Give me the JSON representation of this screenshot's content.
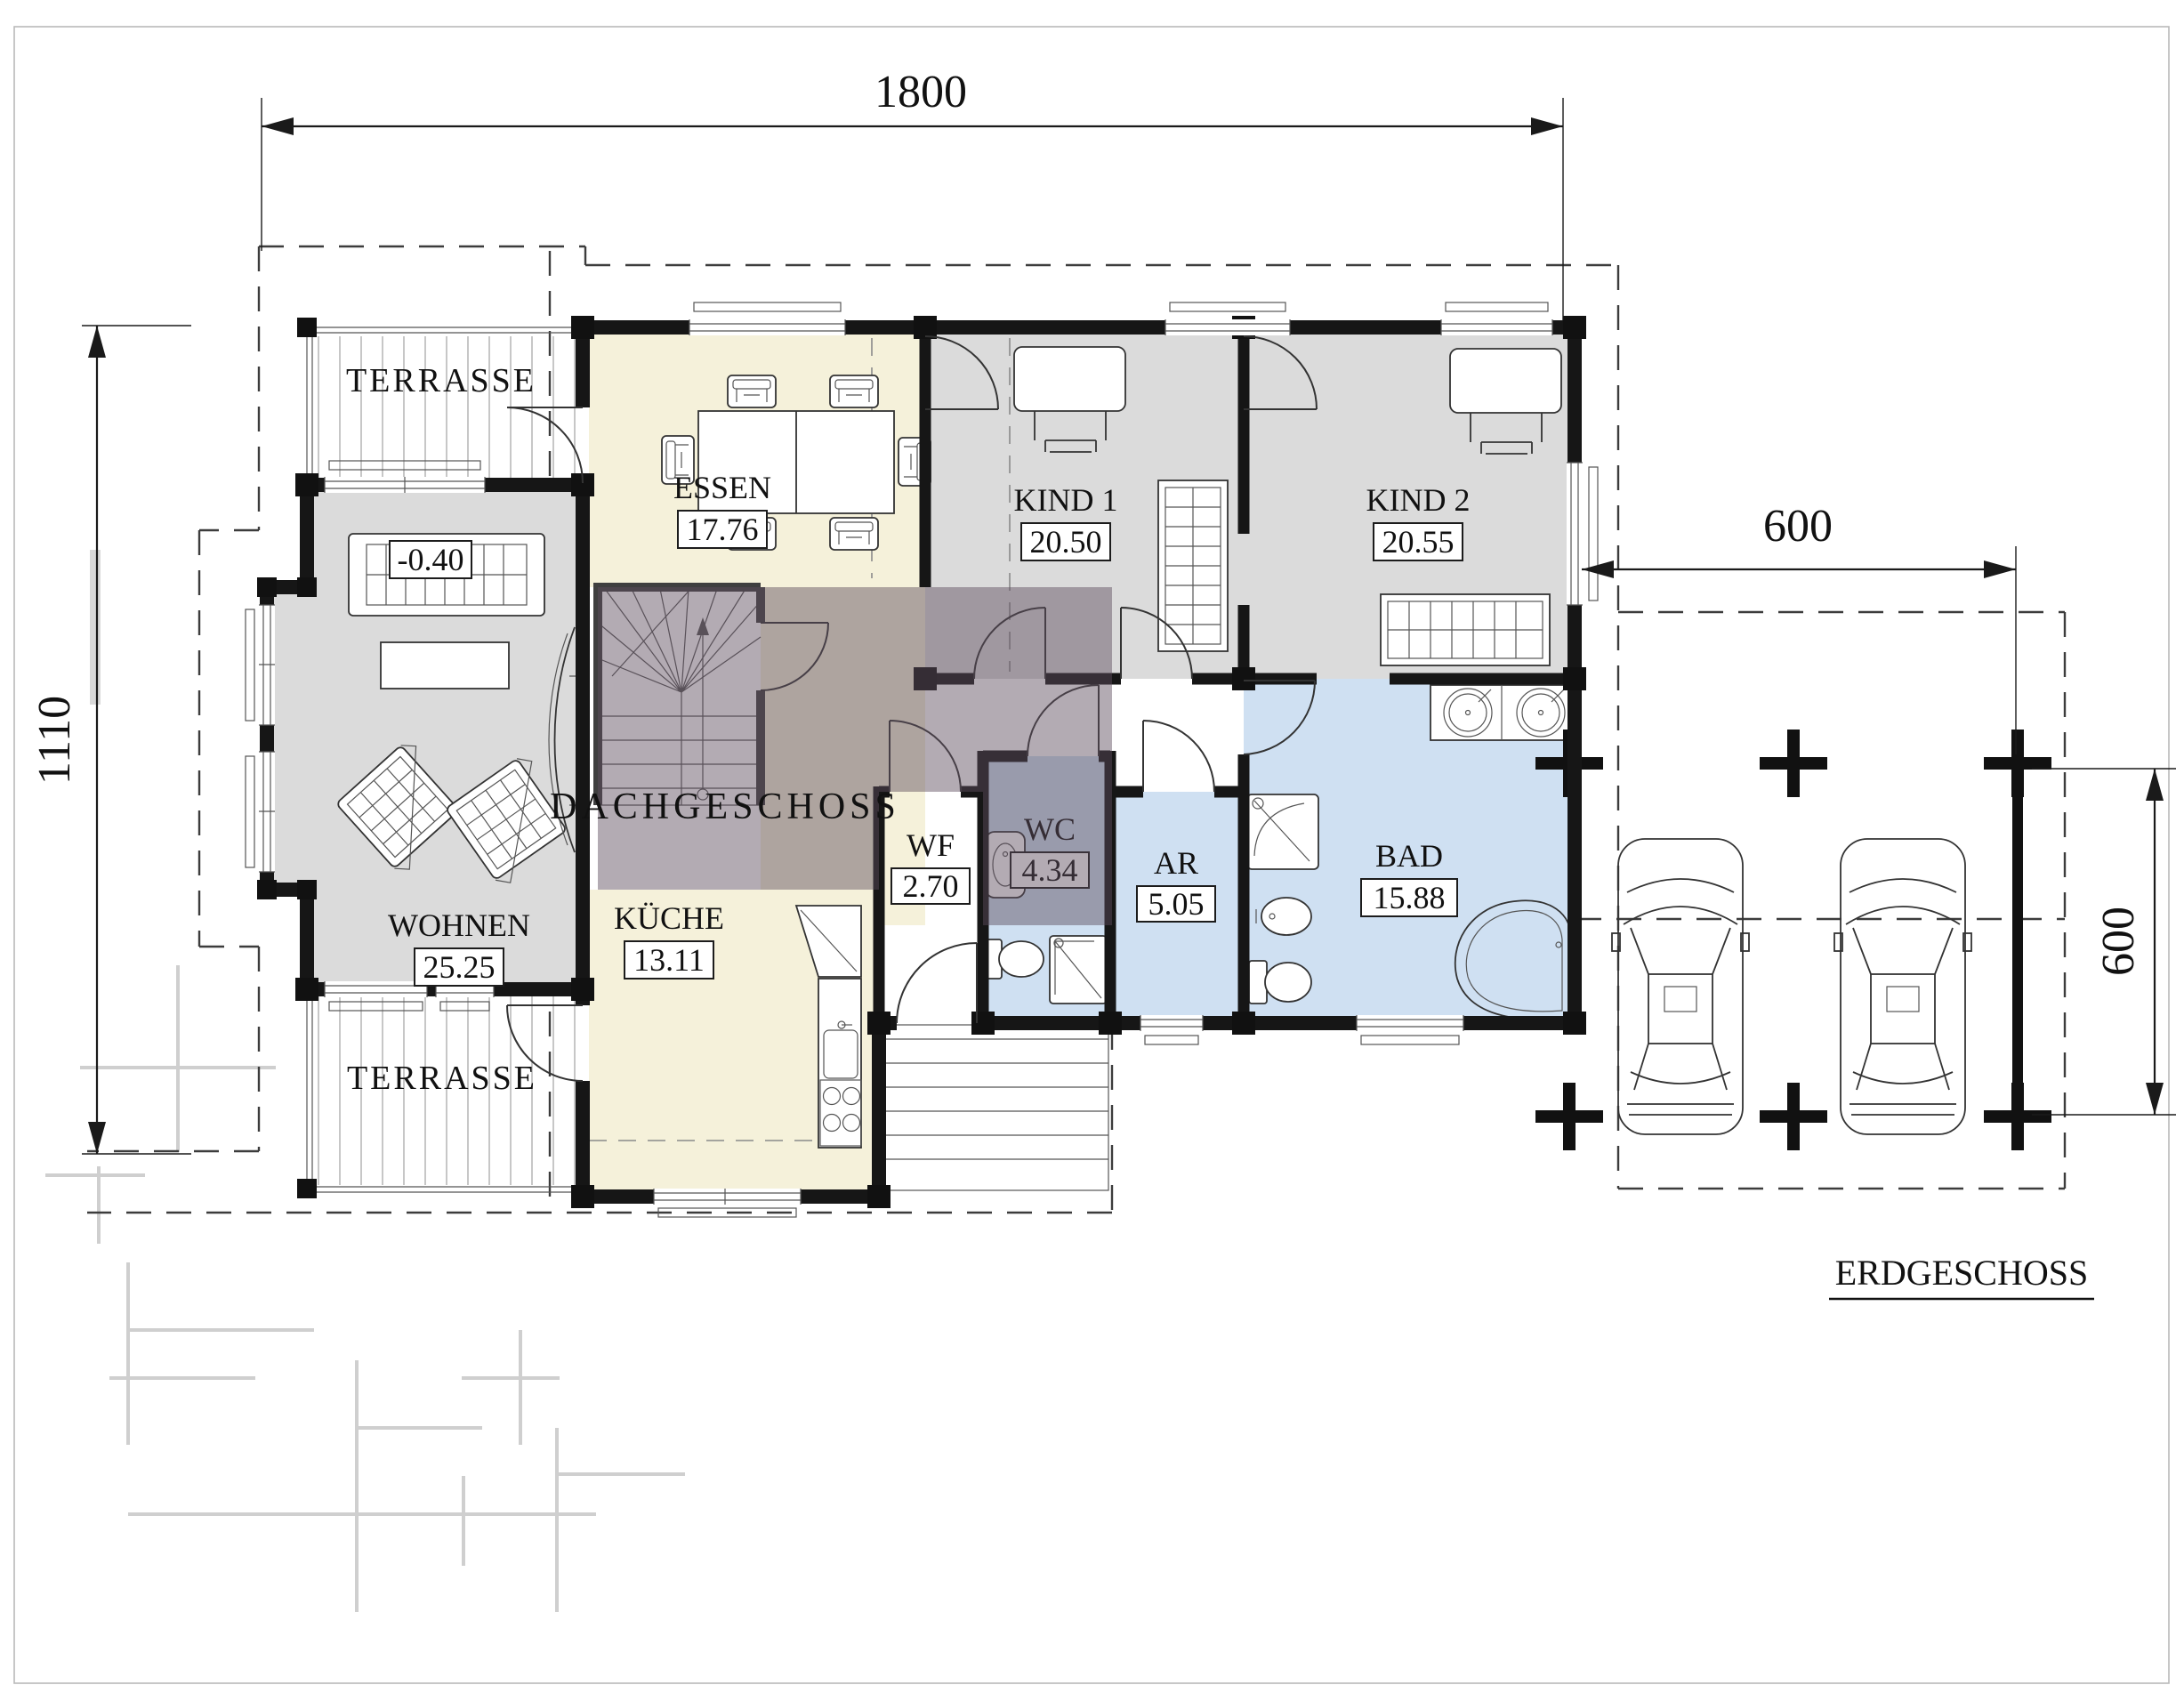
{
  "title": "Erdgeschoss Grundriss",
  "dimensions": {
    "top_width": "1800",
    "left_depth": "1110",
    "carport_width": "600",
    "carport_depth": "600"
  },
  "labels": {
    "terrace_top": "TERRASSE",
    "terrace_bottom": "TERRASSE",
    "overlay": "DACHGESCHOSS",
    "floor": "ERDGESCHOSS",
    "level": "-0.40"
  },
  "rooms": {
    "essen": {
      "name": "ESSEN",
      "area": "17.76"
    },
    "kind1": {
      "name": "KIND 1",
      "area": "20.50"
    },
    "kind2": {
      "name": "KIND 2",
      "area": "20.55"
    },
    "wohnen": {
      "name": "WOHNEN",
      "area": "25.25"
    },
    "kueche": {
      "name": "KÜCHE",
      "area": "13.11"
    },
    "wf": {
      "name": "WF",
      "area": "2.70"
    },
    "wc": {
      "name": "WC",
      "area": "4.34"
    },
    "ar": {
      "name": "AR",
      "area": "5.05"
    },
    "bad": {
      "name": "BAD",
      "area": "15.88"
    }
  },
  "colors": {
    "cream": "#f5f1da",
    "gray": "#dbdbdb",
    "blue": "#cfe0f2",
    "overlay": "#5e4d5e",
    "overlay_text": "#ece6ef",
    "wall": "#161616"
  }
}
